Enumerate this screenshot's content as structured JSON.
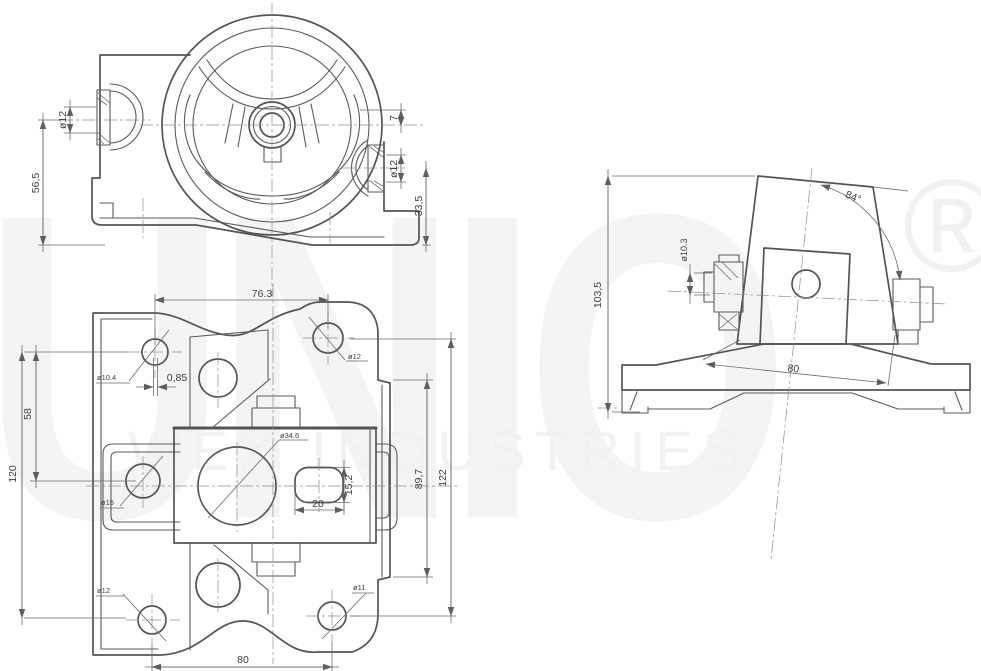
{
  "watermark": {
    "brand": "UNIO",
    "registered": "®",
    "subtitle": "WEX INDUSTRIES"
  },
  "front_view": {
    "labels": {
      "boss_left_dia": "ø12",
      "overall_height": "56,5",
      "top_offset": "7",
      "boss_right_dia": "ø12",
      "boss_right_height": "33,5"
    }
  },
  "top_view": {
    "labels": {
      "top_hole_spacing": "76.3",
      "edge_offset": "0,85",
      "hole_top_left": "ø10.4",
      "hole_top_right": "ø12",
      "left_spacing": "58",
      "overall_height_left": "120",
      "bracket_hole": "ø15",
      "center_bore": "ø34.6",
      "slot_height": "15,2",
      "slot_width": "20",
      "flange_height": "89,7",
      "overall_height_right": "122",
      "hole_bottom_left": "ø12",
      "hole_bottom_right": "ø11",
      "bottom_hole_spacing": "80"
    }
  },
  "side_view": {
    "labels": {
      "overall_height": "103,5",
      "stud_dia": "ø10.3",
      "tilt_angle": "84°",
      "base_width": "80"
    }
  },
  "style": {
    "line_color": "#545454",
    "dim_color": "#6b6b6b",
    "text_color": "#3e3e3e",
    "watermark_color": "#f2f2f2",
    "background": "#ffffff"
  }
}
